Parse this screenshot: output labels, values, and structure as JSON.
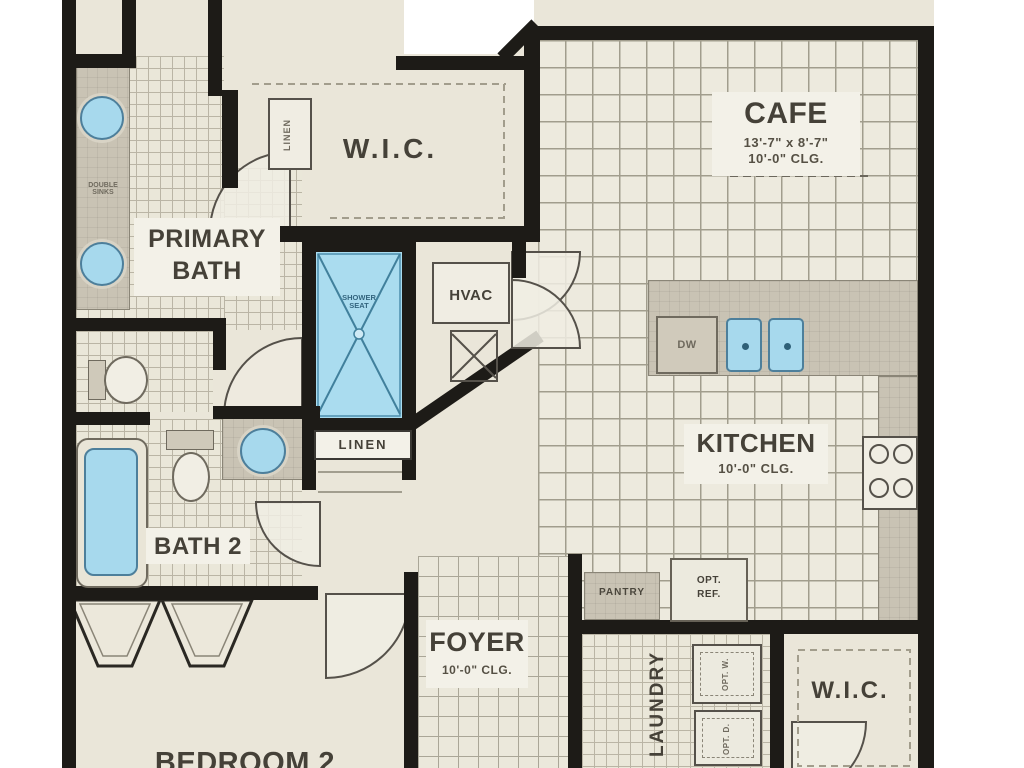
{
  "labels": {
    "cafe": {
      "name": "CAFE",
      "dims": "13'-7\" x 8'-7\"",
      "clg": "10'-0\" CLG."
    },
    "wic1": {
      "name": "W.I.C."
    },
    "primary_bath": {
      "line1": "PRIMARY",
      "line2": "BATH"
    },
    "hvac": {
      "name": "HVAC"
    },
    "kitchen": {
      "name": "KITCHEN",
      "clg": "10'-0\" CLG."
    },
    "dw": {
      "name": "DW"
    },
    "linen_wic": {
      "name": "LINEN"
    },
    "linen_hall": {
      "name": "LINEN"
    },
    "bath2": {
      "name": "BATH 2"
    },
    "pantry": {
      "name": "PANTRY"
    },
    "opt_ref": {
      "line1": "OPT.",
      "line2": "REF."
    },
    "foyer": {
      "name": "FOYER",
      "clg": "10'-0\" CLG."
    },
    "laundry": {
      "name": "LAUNDRY"
    },
    "opt_w": {
      "name": "OPT. W."
    },
    "opt_d": {
      "name": "OPT. D."
    },
    "wic2": {
      "name": "W.I.C."
    },
    "bedroom": {
      "name": "BEDROOM 2"
    },
    "double_sinks": {
      "line1": "DOUBLE",
      "line2": "SINKS"
    },
    "shower": {
      "line1": "SHOWER",
      "line2": "SEAT"
    }
  },
  "colors": {
    "wall": "#1d1b17",
    "floor": "#eae6d9",
    "fixture_blue": "#a7d9ed",
    "counter_gray": "#c9c3b4",
    "label_text": "#454138"
  }
}
